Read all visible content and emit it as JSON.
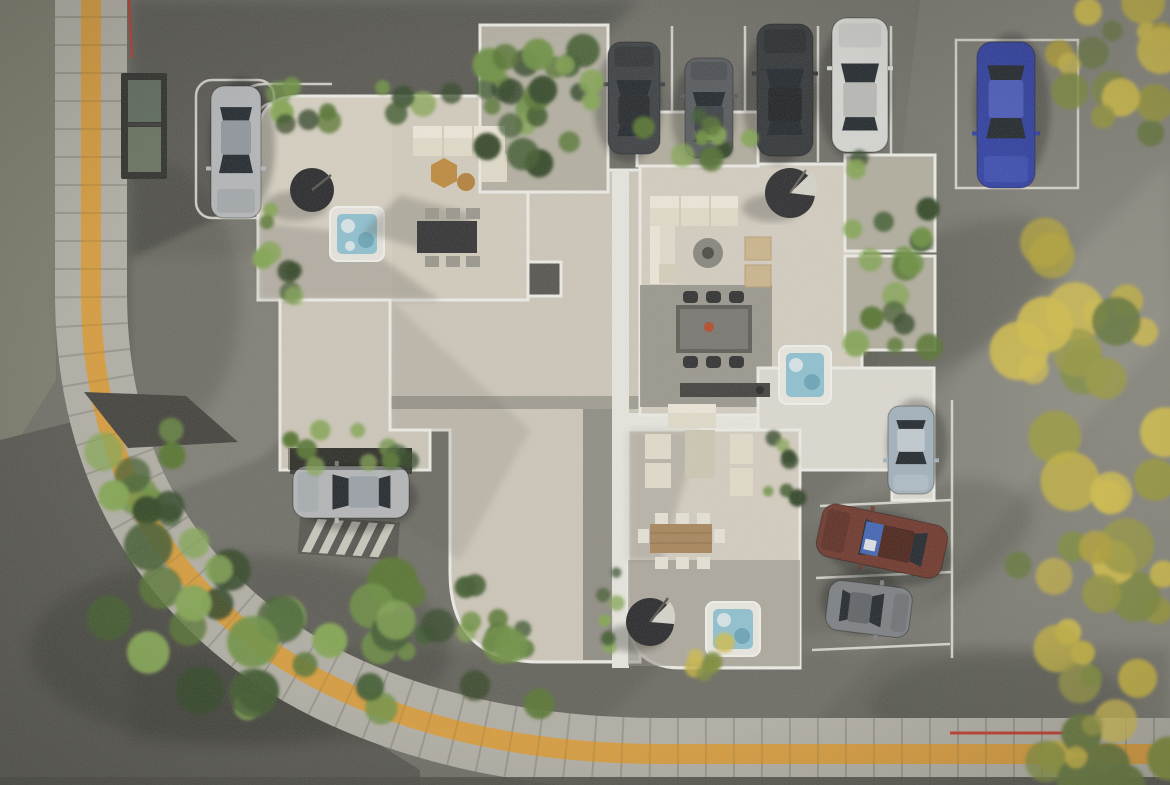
{
  "meta": {
    "title": "Aerial rooftop terrace architectural render",
    "view": "top-down aerial 3D rendering",
    "width_px": 1170,
    "height_px": 785
  },
  "palette": {
    "asphalt": "#6e6d66",
    "asphalt_dark": "#54534d",
    "grass": "#7b7a6b",
    "sidewalk_paver": "#b2afa5",
    "tactile_yellow": "#d99c3b",
    "terrace_floor": "#d8d1c3",
    "roof_gravel": "#cfc8bb",
    "gravel_white": "#dedbd2",
    "planter_soil": "#b2ae9f",
    "railing_white": "#efeee8",
    "hot_tub_water": "#8fc2d2",
    "parasol_black": "#26262a",
    "sofa_cream": "#e6dfcd",
    "wood_table": "#a8855a",
    "stone_table": "#787670",
    "red_marking": "#c03a2c",
    "parking_line": "#e6e5dd"
  },
  "scene": {
    "ground": {
      "street_sides": [
        "left",
        "bottom"
      ],
      "sidewalk": "curved paver band with yellow tactile guiding strip",
      "markings": [
        "red kerb line top-left",
        "red kerb line bottom-right",
        "hatched garage ramp stripes"
      ],
      "skylight": "dark framed twin-pane skylight in pavement, top-left"
    },
    "building": {
      "kind": "rooftop penthouse terraces with white railings",
      "terraces": [
        {
          "id": "terrace-a",
          "features": [
            "black parasol",
            "hot tub",
            "L sofa",
            "hex coffee tables",
            "dining table 6 chairs",
            "perimeter planters"
          ]
        },
        {
          "id": "terrace-b",
          "features": [
            "hanging egg chair",
            "L sofa",
            "round fire table",
            "2 armchairs",
            "stone dining table 6 chairs",
            "outdoor kitchen counter",
            "hot tub",
            "side planters"
          ]
        },
        {
          "id": "terrace-c",
          "features": [
            "lounge set",
            "wooden dining table 8 chairs",
            "black parasol",
            "hot tub",
            "white gravel patio"
          ]
        }
      ],
      "garage": "car exiting under-building garage with striped ramp, west side"
    },
    "vehicles": [
      {
        "id": "car-silver-west",
        "cx": 236,
        "cy": 152,
        "len": 132,
        "wid": 50,
        "angle": 180,
        "body": "#b4b7ba",
        "roof": "#8f969c"
      },
      {
        "id": "car-dark-1",
        "cx": 634,
        "cy": 98,
        "len": 112,
        "wid": 52,
        "angle": 0,
        "body": "#3a3d41",
        "roof": "#23262a"
      },
      {
        "id": "car-graphite",
        "cx": 709,
        "cy": 108,
        "len": 100,
        "wid": 48,
        "angle": 0,
        "body": "#55585c",
        "roof": "#3a3e43"
      },
      {
        "id": "car-black",
        "cx": 785,
        "cy": 90,
        "len": 132,
        "wid": 56,
        "angle": 0,
        "body": "#303336",
        "roof": "#1d2023"
      },
      {
        "id": "car-white",
        "cx": 860,
        "cy": 85,
        "len": 134,
        "wid": 56,
        "angle": 0,
        "body": "#d7d7d3",
        "roof": "#b9bab6"
      },
      {
        "id": "car-blue",
        "cx": 1006,
        "cy": 115,
        "len": 146,
        "wid": 58,
        "angle": 180,
        "body": "#2d3da3",
        "roof": "#4a5bc0"
      },
      {
        "id": "car-steelblue",
        "cx": 911,
        "cy": 450,
        "len": 88,
        "wid": 46,
        "angle": 180,
        "body": "#a3b2bd",
        "roof": "#c2ccd3"
      },
      {
        "id": "car-maroon",
        "cx": 882,
        "cy": 541,
        "len": 128,
        "wid": 54,
        "angle": 282,
        "body": "#6e352a",
        "roof": "#4a2118",
        "sunshade": "#3f63b5"
      },
      {
        "id": "car-gray",
        "cx": 869,
        "cy": 609,
        "len": 84,
        "wid": 50,
        "angle": 97,
        "body": "#7c7f83",
        "roof": "#5f6266"
      },
      {
        "id": "car-garage",
        "cx": 351,
        "cy": 492,
        "len": 116,
        "wid": 52,
        "angle": 270,
        "body": "#b4b7ba",
        "roof": "#9aa1a7"
      }
    ],
    "vegetation": {
      "greens": [
        "#3f5a2e",
        "#55742f",
        "#6d9141",
        "#83a651",
        "#2f4424"
      ],
      "autumn": [
        "#b3a238",
        "#c4b240",
        "#99993f",
        "#7e8c3a",
        "#65773a",
        "#d1bd4a"
      ],
      "planters": [
        {
          "name": "planter-terrace-a-top",
          "x": 262,
          "y": 86,
          "w": 268,
          "h": 40,
          "n": 16,
          "rmin": 7,
          "rmax": 14,
          "pal": "greens"
        },
        {
          "name": "planter-garden-plot",
          "x": 486,
          "y": 30,
          "w": 118,
          "h": 158,
          "n": 22,
          "rmin": 8,
          "rmax": 17,
          "pal": "greens"
        },
        {
          "name": "planter-terrace-a-left",
          "x": 256,
          "y": 208,
          "w": 40,
          "h": 100,
          "n": 8,
          "rmin": 7,
          "rmax": 12,
          "pal": "greens"
        },
        {
          "name": "planter-terrace-b-right",
          "x": 848,
          "y": 158,
          "w": 84,
          "h": 192,
          "n": 18,
          "rmin": 8,
          "rmax": 15,
          "pal": "greens"
        },
        {
          "name": "planter-terrace-b-top",
          "x": 640,
          "y": 114,
          "w": 114,
          "h": 50,
          "n": 10,
          "rmin": 7,
          "rmax": 13,
          "pal": "greens"
        },
        {
          "name": "planter-garage",
          "x": 286,
          "y": 424,
          "w": 142,
          "h": 46,
          "n": 10,
          "rmin": 7,
          "rmax": 12,
          "pal": "greens"
        },
        {
          "name": "planter-roof-south",
          "x": 402,
          "y": 584,
          "w": 126,
          "h": 78,
          "n": 12,
          "rmin": 7,
          "rmax": 13,
          "pal": "greens"
        },
        {
          "name": "planter-bc-strip",
          "x": 768,
          "y": 402,
          "w": 30,
          "h": 98,
          "n": 7,
          "rmin": 5,
          "rmax": 9,
          "pal": "greens"
        },
        {
          "name": "planter-c-west-strip",
          "x": 600,
          "y": 556,
          "w": 20,
          "h": 104,
          "n": 6,
          "rmin": 5,
          "rmax": 8,
          "pal": "greens"
        },
        {
          "name": "shrub-c-south",
          "x": 672,
          "y": 632,
          "w": 60,
          "h": 42,
          "n": 6,
          "rmin": 7,
          "rmax": 12,
          "pal": "autumn"
        }
      ],
      "bushes": [
        {
          "name": "bushes-west",
          "x": 62,
          "y": 430,
          "w": 120,
          "h": 110,
          "n": 10,
          "rmin": 12,
          "rmax": 22,
          "pal": "greens"
        },
        {
          "name": "bushes-southwest-1",
          "x": 96,
          "y": 540,
          "w": 300,
          "h": 170,
          "n": 20,
          "rmin": 14,
          "rmax": 26,
          "pal": "greens"
        },
        {
          "name": "bushes-southwest-2",
          "x": 300,
          "y": 618,
          "w": 240,
          "h": 118,
          "n": 12,
          "rmin": 12,
          "rmax": 20,
          "pal": "greens"
        }
      ],
      "trees": [
        {
          "name": "tree-autumn-northeast",
          "x": 1040,
          "y": 0,
          "w": 130,
          "h": 150,
          "n": 16,
          "rmin": 10,
          "rmax": 24,
          "pal": "autumn"
        },
        {
          "name": "tree-autumn-east",
          "x": 1012,
          "y": 230,
          "w": 158,
          "h": 420,
          "n": 32,
          "rmin": 12,
          "rmax": 30,
          "pal": "autumn"
        },
        {
          "name": "tree-autumn-southeast",
          "x": 1046,
          "y": 650,
          "w": 124,
          "h": 135,
          "n": 14,
          "rmin": 10,
          "rmax": 24,
          "pal": "autumn"
        }
      ]
    },
    "parking": {
      "north_row_stalls": 5,
      "east_column_stalls": 3,
      "west_stall": 1,
      "empty_marked_stall": "northeast white box"
    }
  }
}
